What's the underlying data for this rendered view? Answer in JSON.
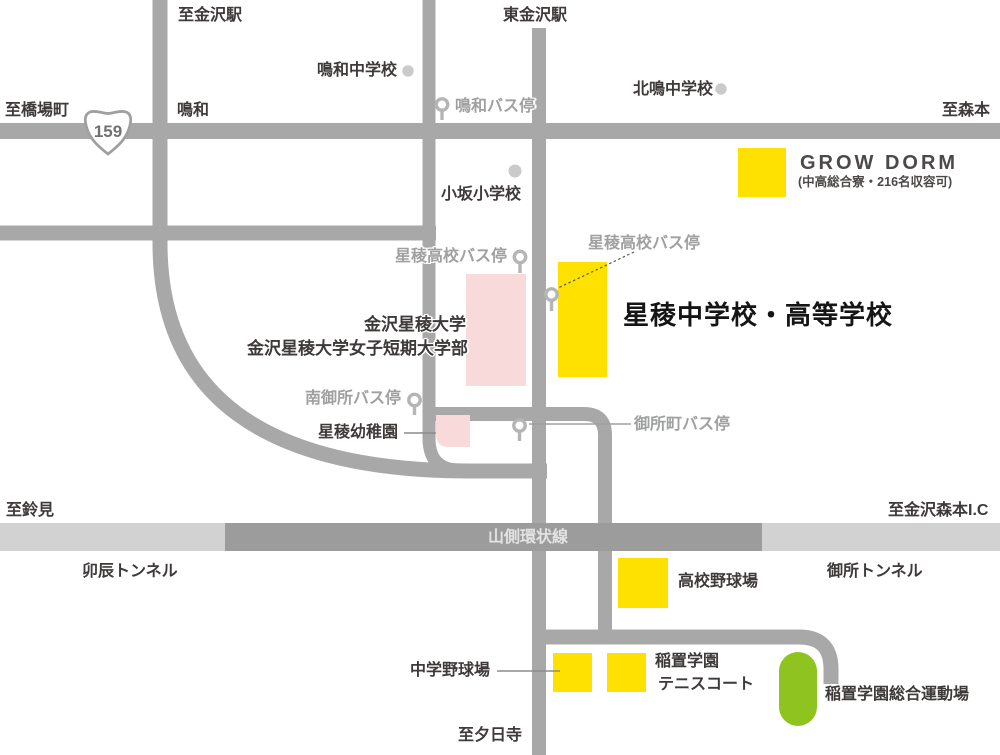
{
  "map": {
    "route_shield": {
      "number": "159"
    },
    "stations": {
      "to_kanazawa_station": "至金沢駅",
      "higashi_kanazawa_station": "東金沢駅"
    },
    "directions": {
      "to_hashibacho": "至橋場町",
      "naruwa_area": "鳴和",
      "to_morimoto": "至森本",
      "to_suzumi": "至鈴見",
      "to_kanazawa_morimoto_ic": "至金沢森本I.C",
      "to_yuhidera": "至夕日寺"
    },
    "roads": {
      "yamagawa_ring_road": "山側環状線",
      "udatsu_tunnel": "卯辰トンネル",
      "gosho_tunnel": "御所トンネル"
    },
    "schools": {
      "naruwa_jhs": "鳴和中学校",
      "kitanaru_jhs": "北鳴中学校",
      "kosaka_es": "小坂小学校"
    },
    "bus_stops": {
      "naruwa": "鳴和バス停",
      "seiryo_hs_west": "星稜高校バス停",
      "seiryo_hs_east": "星稜高校バス停",
      "minami_gosho": "南御所バス停",
      "goshomachi": "御所町バス停"
    },
    "facilities": {
      "grow_dorm": {
        "name": "GROW DORM",
        "note": "(中高総合寮・216名収容可)"
      },
      "seiryo_school": "星稜中学校・高等学校",
      "university_line1": "金沢星稜大学",
      "university_line2": "金沢星稜大学女子短期大学部",
      "kindergarten": "星稜幼稚園",
      "hs_baseball_field": "高校野球場",
      "jhs_baseball_field": "中学野球場",
      "inaoki_tennis_line1": "稲置学園",
      "inaoki_tennis_line2": "テニスコート",
      "inaoki_sports_ground": "稲置学園総合運動場"
    },
    "colors": {
      "road": "#a8a8a8",
      "ring_road": "#9c9c9c",
      "tunnel_road": "#d2d2d2",
      "highlight_yellow": "#ffe100",
      "highlight_pink": "#f8dada",
      "highlight_green": "#8fc31f",
      "marker_dot": "#c9caca",
      "bus_icon": "#b5b5b6",
      "gray_text": "#9fa0a0",
      "dark_text": "#3e3a39"
    }
  }
}
